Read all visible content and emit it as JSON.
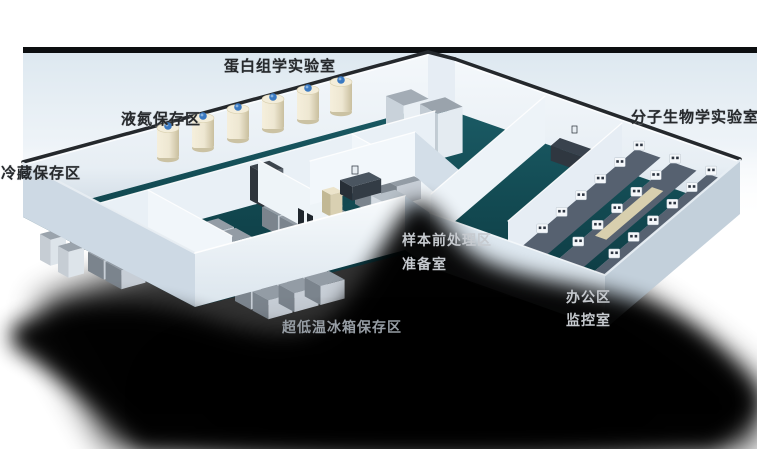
{
  "scene": {
    "description": "isometric 3D cutaway floor plan of a biobank laboratory",
    "labels": {
      "proteomics_lab": "蛋白组学实验室",
      "liquid_nitrogen_area": "液氮保存区",
      "cold_storage_area": "冷藏保存区",
      "molecular_biology_lab": "分子生物学实验室",
      "sample_pretreatment_area": "样本前处理区",
      "preparation_room": "准备室",
      "office_area": "办公区",
      "monitoring_room": "监控室",
      "ult_freezer_area": "超低温冰箱保存区"
    },
    "colors": {
      "background": "#ffffff",
      "backdrop_edge": "#0c0e10",
      "backdrop_wall": "#dde8f0",
      "floor_teal_light": "#1a5a64",
      "floor_teal_mid": "#124951",
      "floor_teal_dark": "#0b343c",
      "wall_lit": "#f3f8fb",
      "wall_shade": "#c9d6e1",
      "shadow": "#000000",
      "freezer_gray_top": "#939ca5",
      "freezer_gray_front": "#c7ced6",
      "freezer_gray_side": "#7b848d",
      "freezer_dark_top": "#3c444c",
      "freezer_dark_front": "#59616b",
      "freezer_dark_side": "#2e353c",
      "tank_cream": "#eee7d2",
      "tank_cream_dark": "#c9bf9e",
      "tank_cap_blue": "#3a79c2",
      "bench_top": "#566170",
      "bench_cream": "#d8cfae",
      "desk_dark": "#39424d",
      "label_dark": "#26292c",
      "label_light": "#c6cacf",
      "label_gray": "#969da4"
    }
  }
}
